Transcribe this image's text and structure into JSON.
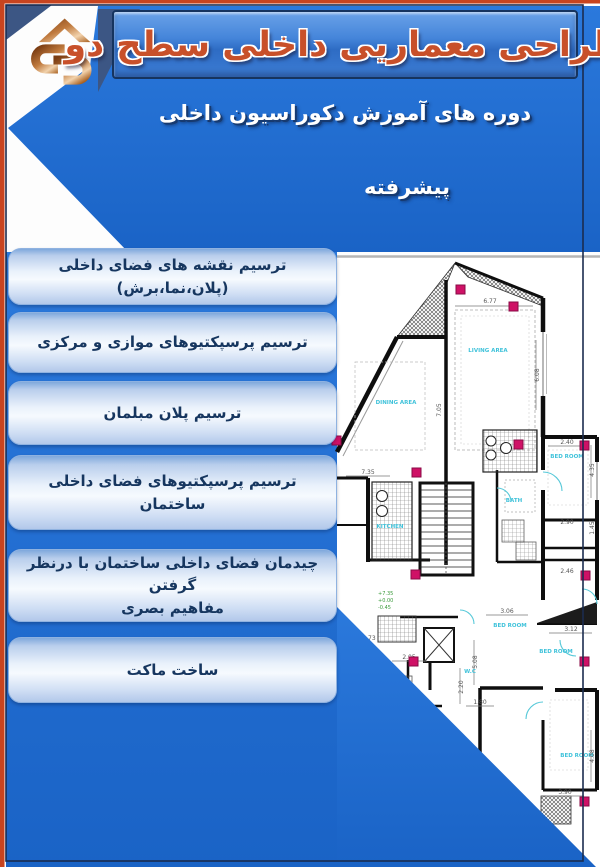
{
  "header": {
    "title": "طراحی معماریی داخلی سطح دو",
    "logo_icon": "architecture-monogram"
  },
  "subtitle": {
    "line1": "دوره های آموزش دکوراسیون داخلی",
    "line2": "پیشرفته"
  },
  "topics": [
    {
      "label": "ترسیم نقشه های فضای داخلی\n(پلان،نما،برش)"
    },
    {
      "label": "ترسیم پرسپکتیوهای موازی و مرکزی"
    },
    {
      "label": "ترسیم پلان مبلمان"
    },
    {
      "label": "ترسیم پرسپکتیوهای فضای داخلی ساختمان"
    },
    {
      "label": "چیدمان فضای داخلی ساختمان با درنظر گرفتن\nمفاهیم بصری"
    },
    {
      "label": "ساخت ماکت"
    }
  ],
  "floor_plan": {
    "labels": {
      "living": "LIVING AREA",
      "dining": "DINING AREA",
      "kitchen": "KITCHEN",
      "bed1": "BED ROOM",
      "bed2": "BED ROOM",
      "bed3": "BED ROOM",
      "bed4": "BED ROOM",
      "wc": "W.C",
      "bath": "BATH"
    },
    "dims": [
      "6.77",
      "6.08",
      "7.05",
      "7.35",
      "2.40",
      "4.35",
      "2.90",
      "1.45",
      "2.46",
      "3.06",
      "5.08",
      "3.12",
      "2.20",
      "1.80",
      "2.05",
      "3.90",
      "4.08",
      "1.73"
    ],
    "levels": [
      "+7.35",
      "+0.00",
      "-0.45"
    ]
  },
  "colors": {
    "band_blue": "#1e6fd2",
    "banner_blue": "#3c7cd4",
    "title_orange": "#c8502a",
    "edge_red": "#c8441f",
    "frame_navy": "#1b2c4f",
    "slate_navy": "#3c5684",
    "logo_copper": "#c07a3e",
    "button_text_navy": "#16365f",
    "marker_pink": "#cf1166",
    "room_label_cyan": "#3fc2da"
  }
}
